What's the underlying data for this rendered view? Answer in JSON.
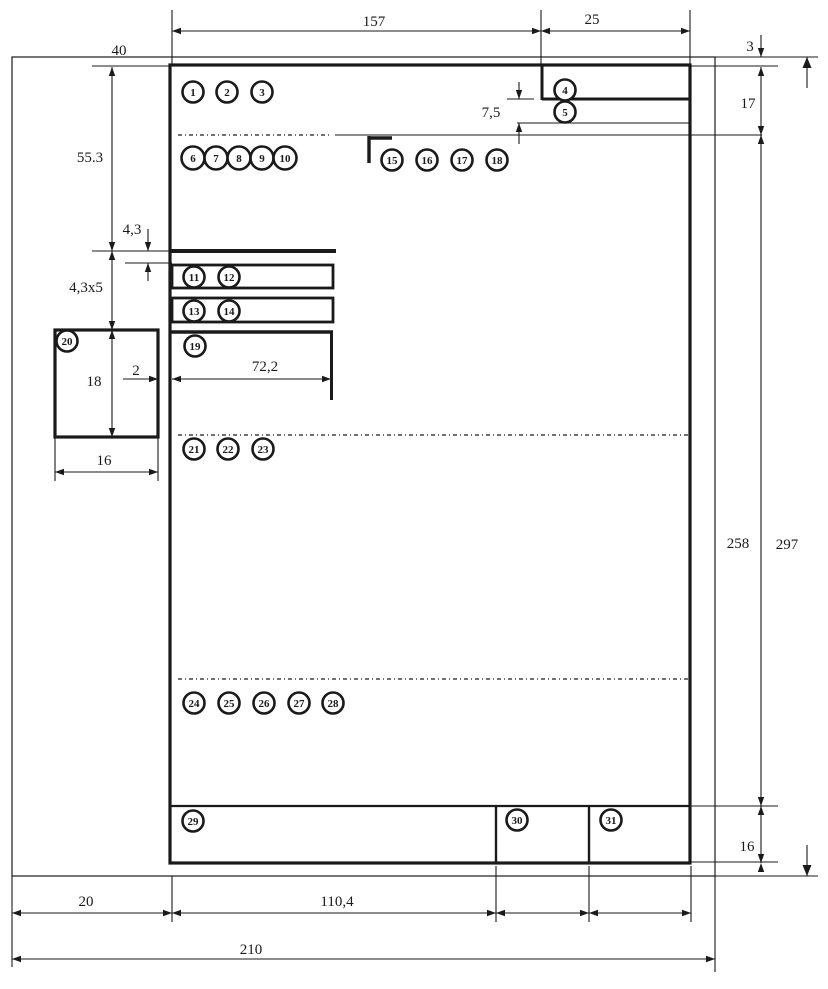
{
  "colors": {
    "ink": "#1a1a1a",
    "paper": "#ffffff"
  },
  "callouts": [
    {
      "n": "1",
      "x": 193,
      "y": 92
    },
    {
      "n": "2",
      "x": 227,
      "y": 92
    },
    {
      "n": "3",
      "x": 262,
      "y": 92
    },
    {
      "n": "4",
      "x": 565,
      "y": 90
    },
    {
      "n": "5",
      "x": 565,
      "y": 112
    },
    {
      "n": "6",
      "x": 193,
      "y": 158
    },
    {
      "n": "7",
      "x": 216,
      "y": 158
    },
    {
      "n": "8",
      "x": 239,
      "y": 158
    },
    {
      "n": "9",
      "x": 262,
      "y": 158
    },
    {
      "n": "10",
      "x": 285,
      "y": 158
    },
    {
      "n": "11",
      "x": 194,
      "y": 277
    },
    {
      "n": "12",
      "x": 229,
      "y": 277
    },
    {
      "n": "13",
      "x": 194,
      "y": 311
    },
    {
      "n": "14",
      "x": 229,
      "y": 311
    },
    {
      "n": "15",
      "x": 392,
      "y": 160
    },
    {
      "n": "16",
      "x": 427,
      "y": 160
    },
    {
      "n": "17",
      "x": 462,
      "y": 160
    },
    {
      "n": "18",
      "x": 497,
      "y": 160
    },
    {
      "n": "19",
      "x": 195,
      "y": 346
    },
    {
      "n": "20",
      "x": 67,
      "y": 341
    },
    {
      "n": "21",
      "x": 194,
      "y": 449
    },
    {
      "n": "22",
      "x": 228,
      "y": 449
    },
    {
      "n": "23",
      "x": 263,
      "y": 449
    },
    {
      "n": "24",
      "x": 194,
      "y": 703
    },
    {
      "n": "25",
      "x": 229,
      "y": 703
    },
    {
      "n": "26",
      "x": 264,
      "y": 703
    },
    {
      "n": "27",
      "x": 299,
      "y": 703
    },
    {
      "n": "28",
      "x": 333,
      "y": 703
    },
    {
      "n": "29",
      "x": 193,
      "y": 821
    },
    {
      "n": "30",
      "x": 517,
      "y": 820
    },
    {
      "n": "31",
      "x": 611,
      "y": 820
    }
  ],
  "dim_labels": [
    {
      "id": "top-width-157",
      "text": "157",
      "x": 374,
      "y": 26,
      "anchor": "middle"
    },
    {
      "id": "top-width-25",
      "text": "25",
      "x": 592,
      "y": 24,
      "anchor": "middle"
    },
    {
      "id": "margin-3",
      "text": "3",
      "x": 750,
      "y": 51,
      "anchor": "middle"
    },
    {
      "id": "header-17",
      "text": "17",
      "x": 748,
      "y": 108,
      "anchor": "middle"
    },
    {
      "id": "body-258",
      "text": "258",
      "x": 738,
      "y": 548,
      "anchor": "middle"
    },
    {
      "id": "page-297",
      "text": "297",
      "x": 787,
      "y": 549,
      "anchor": "middle"
    },
    {
      "id": "footer-16",
      "text": "16",
      "x": 747,
      "y": 851,
      "anchor": "middle"
    },
    {
      "id": "left-40",
      "text": "40",
      "x": 119,
      "y": 55,
      "anchor": "middle"
    },
    {
      "id": "left-55-3",
      "text": "55.3",
      "x": 90,
      "y": 162,
      "anchor": "middle"
    },
    {
      "id": "row-4-3",
      "text": "4,3",
      "x": 132,
      "y": 234,
      "anchor": "middle"
    },
    {
      "id": "rows-4-3x5",
      "text": "4,3x5",
      "x": 86,
      "y": 292,
      "anchor": "middle"
    },
    {
      "id": "box-18",
      "text": "18",
      "x": 94,
      "y": 386,
      "anchor": "middle"
    },
    {
      "id": "gap-2",
      "text": "2",
      "x": 136,
      "y": 375,
      "anchor": "middle"
    },
    {
      "id": "indent-72-2",
      "text": "72,2",
      "x": 265,
      "y": 371,
      "anchor": "middle"
    },
    {
      "id": "box-16",
      "text": "16",
      "x": 104,
      "y": 465,
      "anchor": "middle"
    },
    {
      "id": "notch-7-5",
      "text": "7,5",
      "x": 491,
      "y": 117,
      "anchor": "middle"
    },
    {
      "id": "bottom-20",
      "text": "20",
      "x": 86,
      "y": 906,
      "anchor": "middle"
    },
    {
      "id": "bottom-110-4",
      "text": "110,4",
      "x": 337,
      "y": 906,
      "anchor": "middle"
    },
    {
      "id": "bottom-210",
      "text": "210",
      "x": 251,
      "y": 954,
      "anchor": "middle"
    }
  ]
}
